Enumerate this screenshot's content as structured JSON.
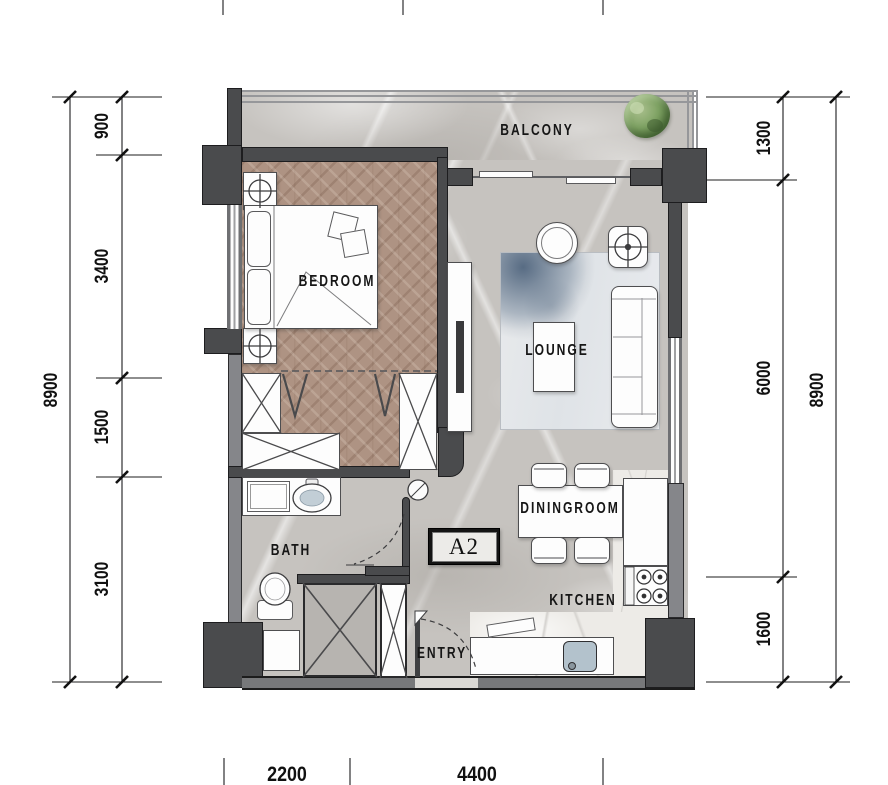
{
  "unit": {
    "label": "A2"
  },
  "rooms": {
    "balcony": "BALCONY",
    "bedroom": "BEDROOM",
    "lounge": "LOUNGE",
    "dining": "DININGROOM",
    "kitchen": "KITCHEN",
    "bath": "BATH",
    "entry": "ENTRY"
  },
  "dimensions": {
    "left_total": "8900",
    "left_segments": [
      "900",
      "3400",
      "1500",
      "3100"
    ],
    "right_segments": [
      "1300",
      "6000",
      "1600"
    ],
    "right_total": "8900",
    "bottom_segments": [
      "2200",
      "4400"
    ]
  },
  "colors": {
    "wall_dark": "#4a4b4d",
    "wall_light": "#85868a",
    "marble_floor": "#c6c3bf",
    "kitchen_floor": "#edebe7",
    "wood_floor": "#ae9383",
    "rug_blue": "#7e91a3",
    "sink_blue": "#b3c2cc",
    "plant_green": "#7ea263",
    "dimension_text": "#111111"
  }
}
